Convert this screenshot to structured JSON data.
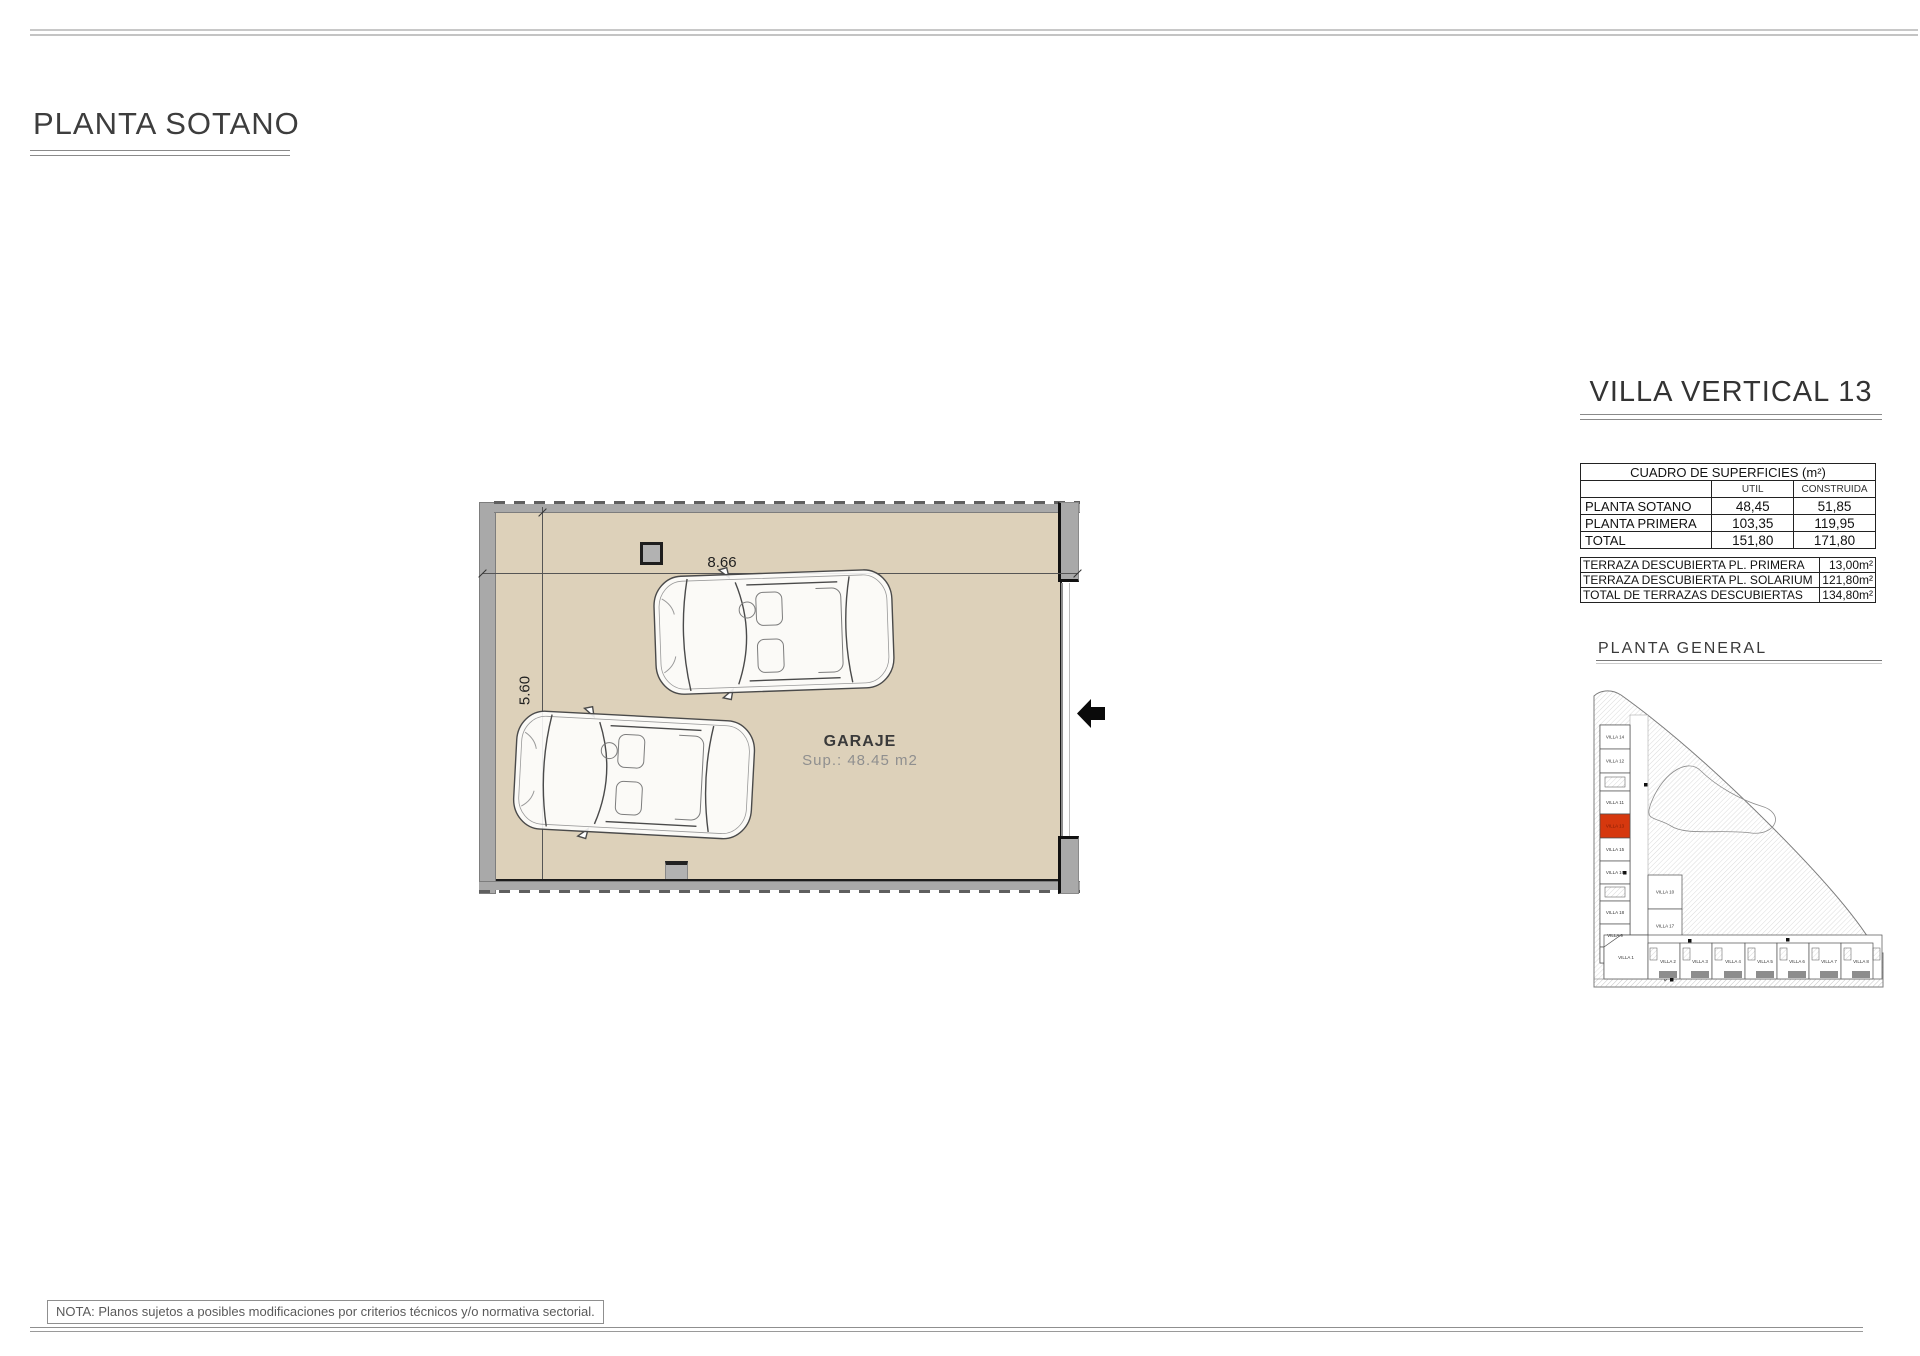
{
  "page": {
    "title": "PLANTA SOTANO",
    "note": "NOTA: Planos sujetos a posibles modificaciones por criterios técnicos y/o normativa sectorial."
  },
  "plan": {
    "room_label": "GARAJE",
    "room_area": "Sup.: 48.45 m2",
    "dim_width": "8.66",
    "dim_height": "5.60"
  },
  "panel": {
    "title": "VILLA VERTICAL 13",
    "surfaces_table": {
      "title": "CUADRO DE SUPERFICIES (m²)",
      "col_headers": [
        "UTIL",
        "CONSTRUIDA"
      ],
      "rows": [
        {
          "label": "PLANTA SOTANO",
          "util": "48,45",
          "construida": "51,85"
        },
        {
          "label": "PLANTA PRIMERA",
          "util": "103,35",
          "construida": "119,95"
        },
        {
          "label": "TOTAL",
          "util": "151,80",
          "construida": "171,80"
        }
      ]
    },
    "terraces_table": {
      "rows": [
        {
          "label": "TERRAZA DESCUBIERTA PL. PRIMERA",
          "value": "13,00m²"
        },
        {
          "label": "TERRAZA DESCUBIERTA PL. SOLARIUM",
          "value": "121,80m²"
        },
        {
          "label": "TOTAL DE TERRAZAS DESCUBIERTAS",
          "value": "134,80m²"
        }
      ]
    },
    "siteplan": {
      "title": "PLANTA  GENERAL",
      "highlighted_villa": "VILLA 13",
      "left_column": [
        "VILLA 14",
        "VILLA 12",
        "VILLA 11",
        "VILLA 13",
        "VILLA 15",
        "VILLA 16",
        "VILLA 18",
        "VILLA 9"
      ],
      "middle_column": [
        "VILLA 10",
        "VILLA 17"
      ],
      "bottom_row": [
        "VILLA 1",
        "VILLA 2",
        "VILLA 3",
        "VILLA 4",
        "VILLA 5",
        "VILLA 6",
        "VILLA 7",
        "VILLA 8"
      ]
    }
  },
  "colors": {
    "floor": "#ddd1ba",
    "wall": "#a9a9a9",
    "highlight": "#d6380e"
  }
}
